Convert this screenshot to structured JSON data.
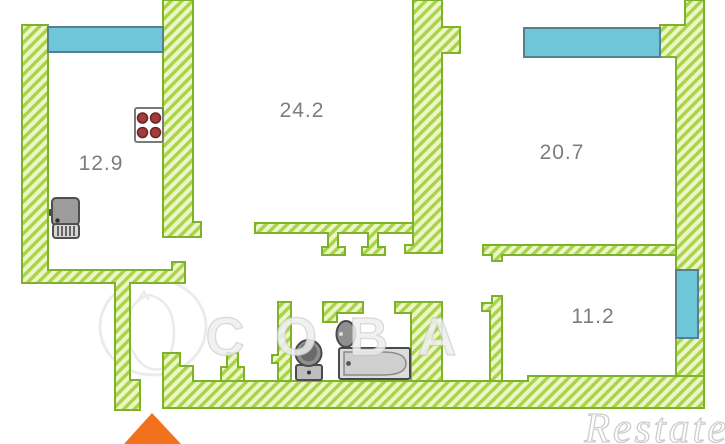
{
  "plan": {
    "type": "apartment-floor-plan",
    "rooms": [
      {
        "name": "kitchen",
        "area": "12.9"
      },
      {
        "name": "living-room",
        "area": "24.2"
      },
      {
        "name": "bedroom",
        "area": "20.7"
      },
      {
        "name": "small-room",
        "area": "11.2"
      }
    ],
    "fixtures": [
      {
        "icon": "stove-icon",
        "room": "kitchen"
      },
      {
        "icon": "kitchen-sink-icon",
        "room": "kitchen"
      },
      {
        "icon": "toilet-icon",
        "room": "wc"
      },
      {
        "icon": "washbasin-icon",
        "room": "bathroom"
      },
      {
        "icon": "bathtub-icon",
        "room": "bathroom"
      }
    ],
    "windows": [
      "kitchen-window",
      "bedroom-window",
      "small-room-window"
    ],
    "entrance_marker": "entrance-arrow",
    "colors": {
      "wall_fill": "#eef5c6",
      "wall_stripe": "#a8d44c",
      "wall_outline": "#7db32a",
      "window_fill": "#6ec6d8",
      "window_border": "#56808c",
      "entrance": "#f2711c",
      "label_text": "#7d7d7d"
    }
  },
  "watermarks": {
    "center_text": "СОВА",
    "corner_text": "Restate"
  }
}
